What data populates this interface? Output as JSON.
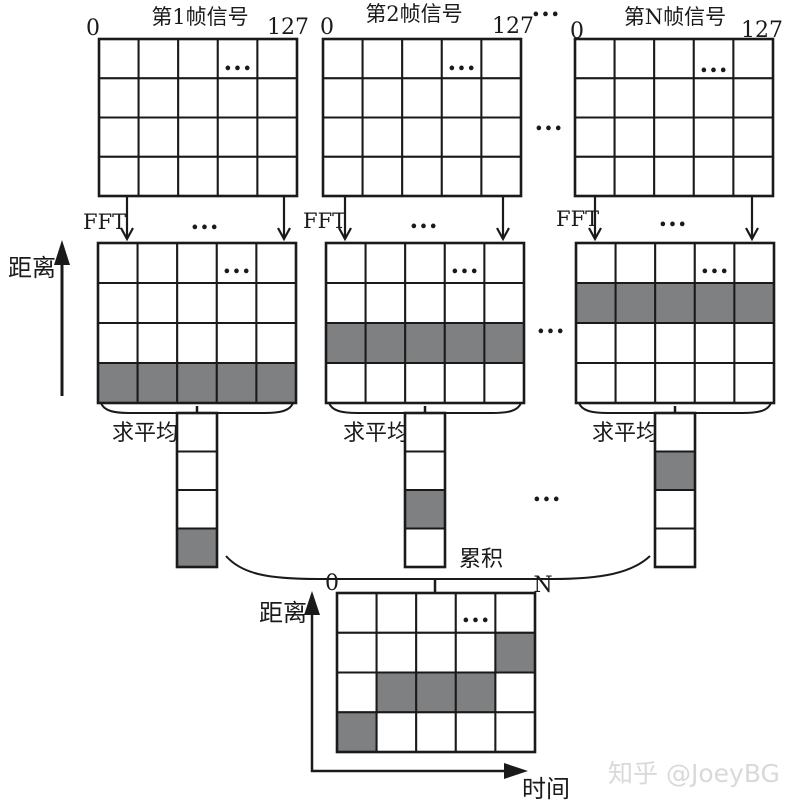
{
  "colors": {
    "line": "#1a1a1a",
    "gray": "#7e8081",
    "watermark": "#d9d9d9"
  },
  "labels": {
    "ellipsis": "...",
    "fft": "FFT",
    "avg": "求平均",
    "accumulate": "累积",
    "range_axis": "距离",
    "time_axis": "时间"
  },
  "frames": [
    {
      "title": "第1帧信号",
      "left_tick": "0",
      "right_tick": "127",
      "range_gray_row": 4,
      "avg_gray_cell": 4
    },
    {
      "title": "第2帧信号",
      "left_tick": "0",
      "right_tick": "127",
      "range_gray_row": 3,
      "avg_gray_cell": 3
    },
    {
      "title": "第N帧信号",
      "left_tick": "0",
      "right_tick": "127",
      "range_gray_row": 2,
      "avg_gray_cell": 2
    }
  ],
  "signal_grid": {
    "cols": 5,
    "rows": 4
  },
  "range_grid": {
    "cols": 5,
    "rows": 4
  },
  "avg_vector": {
    "cells": 4
  },
  "output_grid": {
    "cols": 5,
    "rows": 4,
    "left_tick": "0",
    "right_tick": "N",
    "gray_cells": [
      [
        2,
        5
      ],
      [
        3,
        2
      ],
      [
        3,
        3
      ],
      [
        3,
        4
      ],
      [
        4,
        1
      ]
    ],
    "ellipsis_cell": [
      1,
      4
    ]
  },
  "watermark": "知乎 @JoeyBG"
}
